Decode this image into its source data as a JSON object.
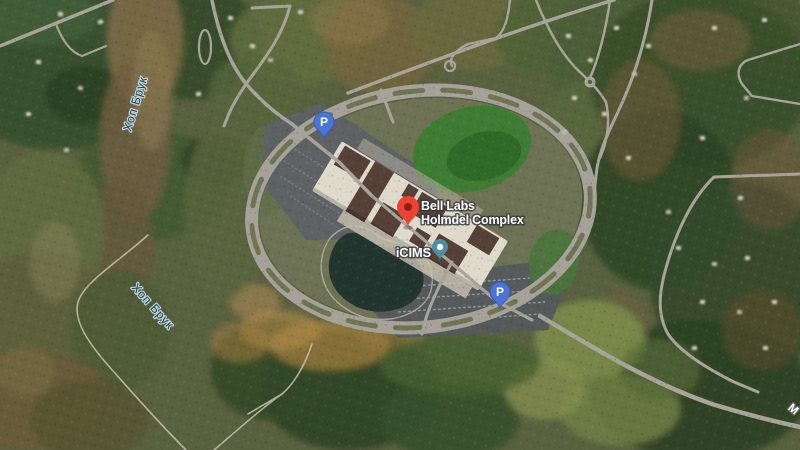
{
  "map": {
    "view_type": "satellite",
    "labels": {
      "poi_main": {
        "line1": "Bell Labs",
        "line2": "Holmdel Complex"
      },
      "poi_secondary": "iCIMS",
      "water_label_1": "Хоп Брук",
      "water_label_2": "Хоп Брук",
      "road_label_partial": "M",
      "parking_glyph": "P"
    },
    "colors": {
      "pin_red": "#EA4335",
      "pin_red_hole": "#8E1F14",
      "parking_blue": "#4A75D8",
      "parking_blue_edge": "#3A5CB5",
      "poi_teal": "#4D8FA0",
      "water_label_text": "#1D4257",
      "road_gray": "#A8A49A"
    }
  }
}
